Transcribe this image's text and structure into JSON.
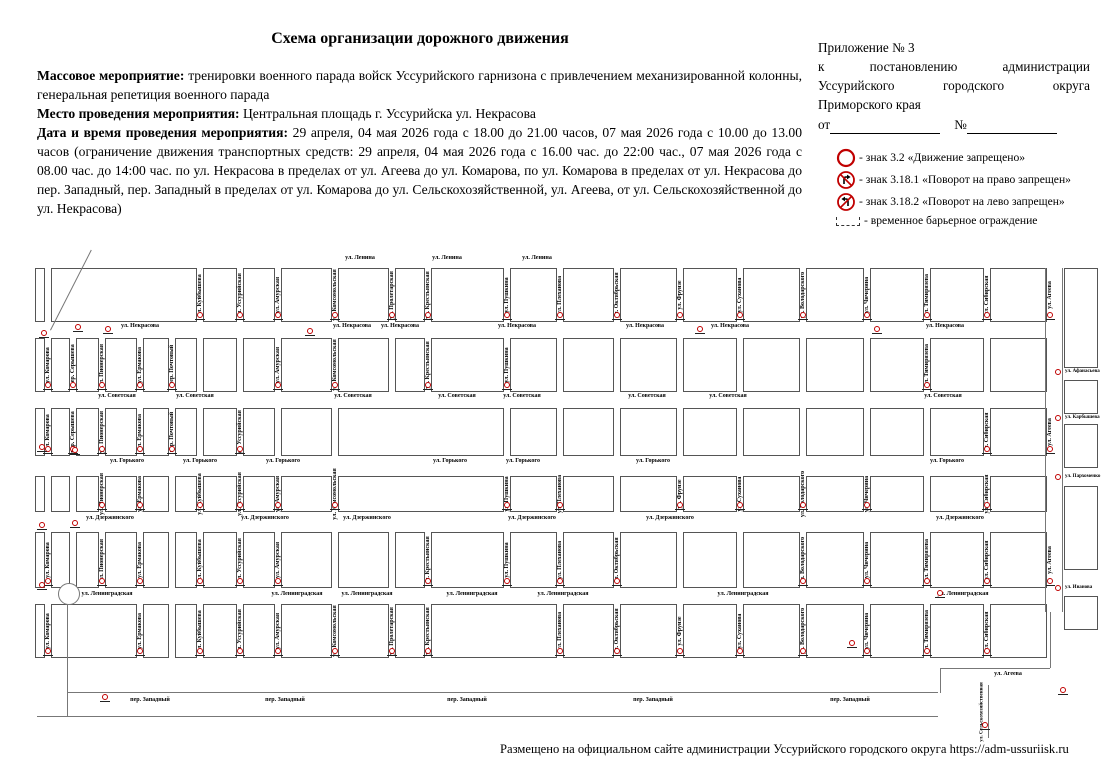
{
  "title": "Схема организации дорожного движения",
  "intro": {
    "event_label": "Массовое мероприятие:",
    "event_text": "тренировки военного парада войск Уссурийского гарнизона с привлечением механизированной колонны, генеральная репетиция военного парада",
    "place_label": "Место проведения мероприятия:",
    "place_text": "Центральная площадь г. Уссурийска ул. Некрасова",
    "datetime_label": "Дата и время проведения мероприятия:",
    "datetime_text": "29 апреля, 04 мая 2026 года с 18.00 до 21.00 часов, 07 мая 2026 года с 10.00 до 13.00 часов (ограничение движения транспортных средств: 29 апреля, 04 мая 2026 года с 16.00 час. до 22:00 час., 07 мая 2026 года с 08.00 час. до 14:00 час. по ул. Некрасова в пределах от ул. Агеева до ул. Комарова, по ул. Комарова в пределах от ул. Некрасова до пер. Западный, пер. Западный в пределах от ул. Комарова до ул. Сельскохозяйственной, ул. Агеева, от ул. Сельскохозяйственной до ул. Некрасова)"
  },
  "appendix": {
    "line1": "Приложение № 3",
    "line2": "к постановлению администрации",
    "line3": "Уссурийского городского округа",
    "line4": "Приморского края",
    "from_label": "от",
    "number_label": "№"
  },
  "legend": {
    "items": [
      {
        "icon": "no-entry-sign-icon",
        "text": "- знак 3.2 «Движение запрещено»"
      },
      {
        "icon": "no-right-turn-sign-icon",
        "text": "- знак 3.18.1 «Поворот на право запрещен»"
      },
      {
        "icon": "no-left-turn-sign-icon",
        "text": "- знак 3.18.2 «Поворот на лево запрещен»"
      },
      {
        "icon": "barrier-icon",
        "text": "- временное барьерное ограждение"
      }
    ]
  },
  "colors": {
    "sign_red": "#c00000",
    "block_border": "#555555"
  },
  "footer": "Размещено на официальном сайте администрации Уссурийского городского округа https://adm-ussuriisk.ru",
  "map": {
    "columns": [
      {
        "name": "",
        "x": 32
      },
      {
        "name": "ул. Комарова",
        "x": 48,
        "bands": [
          1,
          2,
          4,
          5
        ]
      },
      {
        "name": "пер. Серышева",
        "x": 73,
        "bands": [
          1,
          2
        ]
      },
      {
        "name": "ул. Пионерская",
        "x": 102,
        "bands": [
          1,
          2,
          3,
          4
        ]
      },
      {
        "name": "ул. Ермакова",
        "x": 140,
        "bands": [
          1,
          2,
          3,
          4,
          5
        ]
      },
      {
        "name": "пер. Почтовый",
        "x": 172,
        "bands": [
          1,
          2
        ]
      },
      {
        "name": "ул. Куйбышева",
        "x": 200,
        "bands": [
          0,
          3,
          4,
          5
        ]
      },
      {
        "name": "ул. Уссурийская",
        "x": 240,
        "bands": [
          0,
          2,
          3,
          4,
          5
        ]
      },
      {
        "name": "ул. Амурская",
        "x": 278,
        "bands": [
          0,
          1,
          3,
          4,
          5
        ]
      },
      {
        "name": "ул. Комсомольская",
        "x": 335,
        "bands": [
          0,
          1,
          3,
          5
        ]
      },
      {
        "name": "ул. Пролетарская",
        "x": 392,
        "bands": [
          0,
          5
        ]
      },
      {
        "name": "ул. Крестьянская",
        "x": 428,
        "bands": [
          0,
          1,
          4,
          5
        ]
      },
      {
        "name": "ул. Пушкина",
        "x": 507,
        "bands": [
          0,
          1,
          3,
          4
        ]
      },
      {
        "name": "ул. Плеханова",
        "x": 560,
        "bands": [
          0,
          3,
          4,
          5
        ]
      },
      {
        "name": "ул. Октябрьская",
        "x": 617,
        "bands": [
          0,
          4,
          5
        ]
      },
      {
        "name": "ул. Фрунзе",
        "x": 680,
        "bands": [
          0,
          3,
          5
        ]
      },
      {
        "name": "ул. Суханова",
        "x": 740,
        "bands": [
          0,
          3,
          5
        ]
      },
      {
        "name": "ул. Володарского",
        "x": 803,
        "bands": [
          0,
          3,
          4,
          5
        ]
      },
      {
        "name": "ул. Чичерина",
        "x": 867,
        "bands": [
          0,
          3,
          4,
          5
        ]
      },
      {
        "name": "ул. Тимирязева",
        "x": 927,
        "bands": [
          0,
          1,
          4,
          5
        ]
      },
      {
        "name": "ул. Сибирская",
        "x": 987,
        "bands": [
          0,
          2,
          3,
          4,
          5
        ]
      },
      {
        "name": "ул. Агеева",
        "x": 1050,
        "bands": [
          0,
          2,
          4
        ]
      }
    ],
    "bands": [
      {
        "y1": 268,
        "y2": 322,
        "merges": [
          [
            1,
            5
          ]
        ]
      },
      {
        "y1": 338,
        "y2": 392
      },
      {
        "y1": 408,
        "y2": 456,
        "merges": [
          [
            9,
            11
          ]
        ]
      },
      {
        "y1": 476,
        "y2": 512,
        "merges": [
          [
            9,
            11
          ]
        ]
      },
      {
        "y1": 532,
        "y2": 588
      },
      {
        "y1": 604,
        "y2": 658,
        "merges": [
          [
            1,
            3
          ],
          [
            11,
            12
          ]
        ]
      }
    ],
    "h_streets": [
      {
        "name": "ул. Ленина",
        "y": 258,
        "xs": [
          360,
          447,
          537
        ]
      },
      {
        "name": "ул. Некрасова",
        "y": 326,
        "xs": [
          140,
          352,
          400,
          517,
          645,
          730,
          945
        ]
      },
      {
        "name": "ул. Советская",
        "y": 396,
        "xs": [
          117,
          195,
          353,
          457,
          522,
          647,
          728,
          943
        ]
      },
      {
        "name": "ул. Горького",
        "y": 461,
        "xs": [
          127,
          200,
          283,
          450,
          523,
          653,
          947
        ]
      },
      {
        "name": "ул. Дзержинского",
        "y": 518,
        "xs": [
          110,
          265,
          367,
          532,
          670,
          960
        ]
      },
      {
        "name": "ул. Ленинградская",
        "y": 594,
        "xs": [
          107,
          297,
          367,
          472,
          563,
          743,
          963
        ]
      },
      {
        "name": "пер. Западный",
        "y": 700,
        "xs": [
          150,
          285,
          467,
          653,
          850
        ]
      }
    ],
    "east": {
      "x": 1064,
      "w": 34,
      "blocks": [
        {
          "y": 268,
          "h": 100
        },
        {
          "y": 380,
          "h": 34
        },
        {
          "y": 424,
          "h": 44
        },
        {
          "y": 486,
          "h": 84
        },
        {
          "y": 596,
          "h": 34
        }
      ],
      "streets": [
        {
          "name": "ул. Афанасьева",
          "y": 372
        },
        {
          "name": "ул. Карбышева",
          "y": 418
        },
        {
          "name": "ул. Пархоменко",
          "y": 477
        },
        {
          "name": "ул. Иванова",
          "y": 588
        }
      ]
    },
    "free_labels": [
      {
        "name": "ул. Агеева",
        "x": 1008,
        "y": 674,
        "rot": 0
      },
      {
        "name": "ул. Сельскохозяйственная",
        "x": 982,
        "y": 712,
        "rot": -90
      }
    ],
    "lines": [
      {
        "x": 67,
        "y": 600,
        "w": 1,
        "h": 116
      },
      {
        "x": 67,
        "y": 692,
        "w": 871,
        "h": 1
      },
      {
        "x": 37,
        "y": 716,
        "w": 901,
        "h": 1
      },
      {
        "x": 1045,
        "y": 268,
        "w": 1,
        "h": 344
      },
      {
        "x": 1062,
        "y": 268,
        "w": 1,
        "h": 344
      },
      {
        "x": 1050,
        "y": 612,
        "w": 1,
        "h": 56
      },
      {
        "x": 940,
        "y": 668,
        "w": 110,
        "h": 1
      },
      {
        "x": 940,
        "y": 668,
        "w": 1,
        "h": 25
      },
      {
        "x": 988,
        "y": 685,
        "w": 1,
        "h": 53
      },
      {
        "x": 50,
        "y": 330,
        "w": 90,
        "h": 1,
        "rot": -63
      }
    ],
    "roundabout": {
      "x": 58,
      "y": 583,
      "d": 20
    },
    "extra_signs": [
      {
        "x": 78,
        "y": 332
      },
      {
        "x": 44,
        "y": 338
      },
      {
        "x": 108,
        "y": 334
      },
      {
        "x": 310,
        "y": 336
      },
      {
        "x": 700,
        "y": 334
      },
      {
        "x": 877,
        "y": 334
      },
      {
        "x": 42,
        "y": 452
      },
      {
        "x": 75,
        "y": 455
      },
      {
        "x": 42,
        "y": 530
      },
      {
        "x": 75,
        "y": 528
      },
      {
        "x": 42,
        "y": 590
      },
      {
        "x": 105,
        "y": 702
      },
      {
        "x": 852,
        "y": 648
      },
      {
        "x": 940,
        "y": 598
      },
      {
        "x": 985,
        "y": 730
      },
      {
        "x": 1063,
        "y": 695
      }
    ]
  }
}
